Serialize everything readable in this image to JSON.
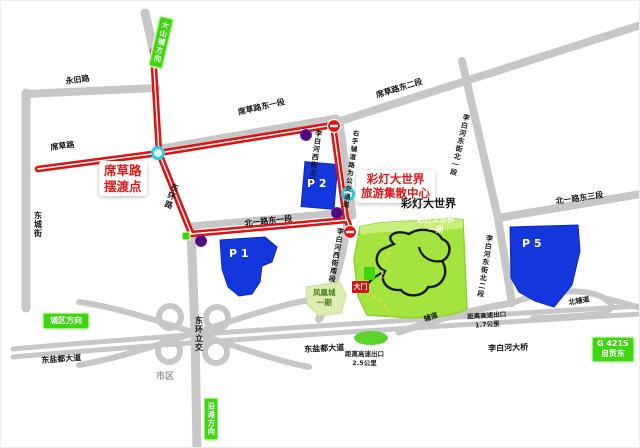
{
  "colors": {
    "road_gray": "#c7c7c7",
    "route_red": "#dc1414",
    "parking_blue": "#1437dd",
    "park_green": "#a3e43e",
    "sign_green": "#3ed60e",
    "marker_purple": "#4c0b7e",
    "marker_cyan": "#2fc8e6",
    "annotation_red": "#e01818"
  },
  "roads": {
    "yongjiu": "永旧路",
    "dongchengjie": "东城街",
    "xicao": "席草路",
    "xicao_dong1": "席草路东一段",
    "xicao_dong2": "席草路东二段",
    "donghuan": "东环路",
    "beiyi_dong1": "北一路东一段",
    "beiyi_dong3": "北一路东三段",
    "libaihe_xi_bei": "李白河西街北段",
    "libaihe_xi_nan": "李白河西街南段",
    "libaihe_dong_bei1": "李白河东街北一段",
    "libaihe_dong_bei2": "李白河东街北二段",
    "dongyandu_west": "东盐都大道",
    "dongyandu_east": "东盐都大道",
    "libaihe_bridge": "李白河大桥",
    "fudao": "辅道",
    "beifudao": "北辅道",
    "donghuan_interchange": "东环立交",
    "shiqu": "市区"
  },
  "notes": {
    "bus_lane": "右手辅道路为公交通道",
    "exit_1_7": "距离高速出口\n1.7公里",
    "exit_2_5": "距离高速出口\n2.5公里"
  },
  "places": {
    "ferry_point": "席草路\n摆渡点",
    "center": "彩灯大世界\n旅游集散中心",
    "lantern_world": "彩灯大世界",
    "park_phase1": "彩灯大世界\n一期",
    "gate": "大门",
    "fenghuang": "凤凰城\n一期"
  },
  "signs": {
    "dashanpu": "大山铺方向",
    "chengqu": "城区方向",
    "yantan": "沿滩方向",
    "g4215": "G 4215\n自贡东"
  },
  "parking": {
    "p1": "P 1",
    "p2": "P 2",
    "p5": "P 5"
  }
}
